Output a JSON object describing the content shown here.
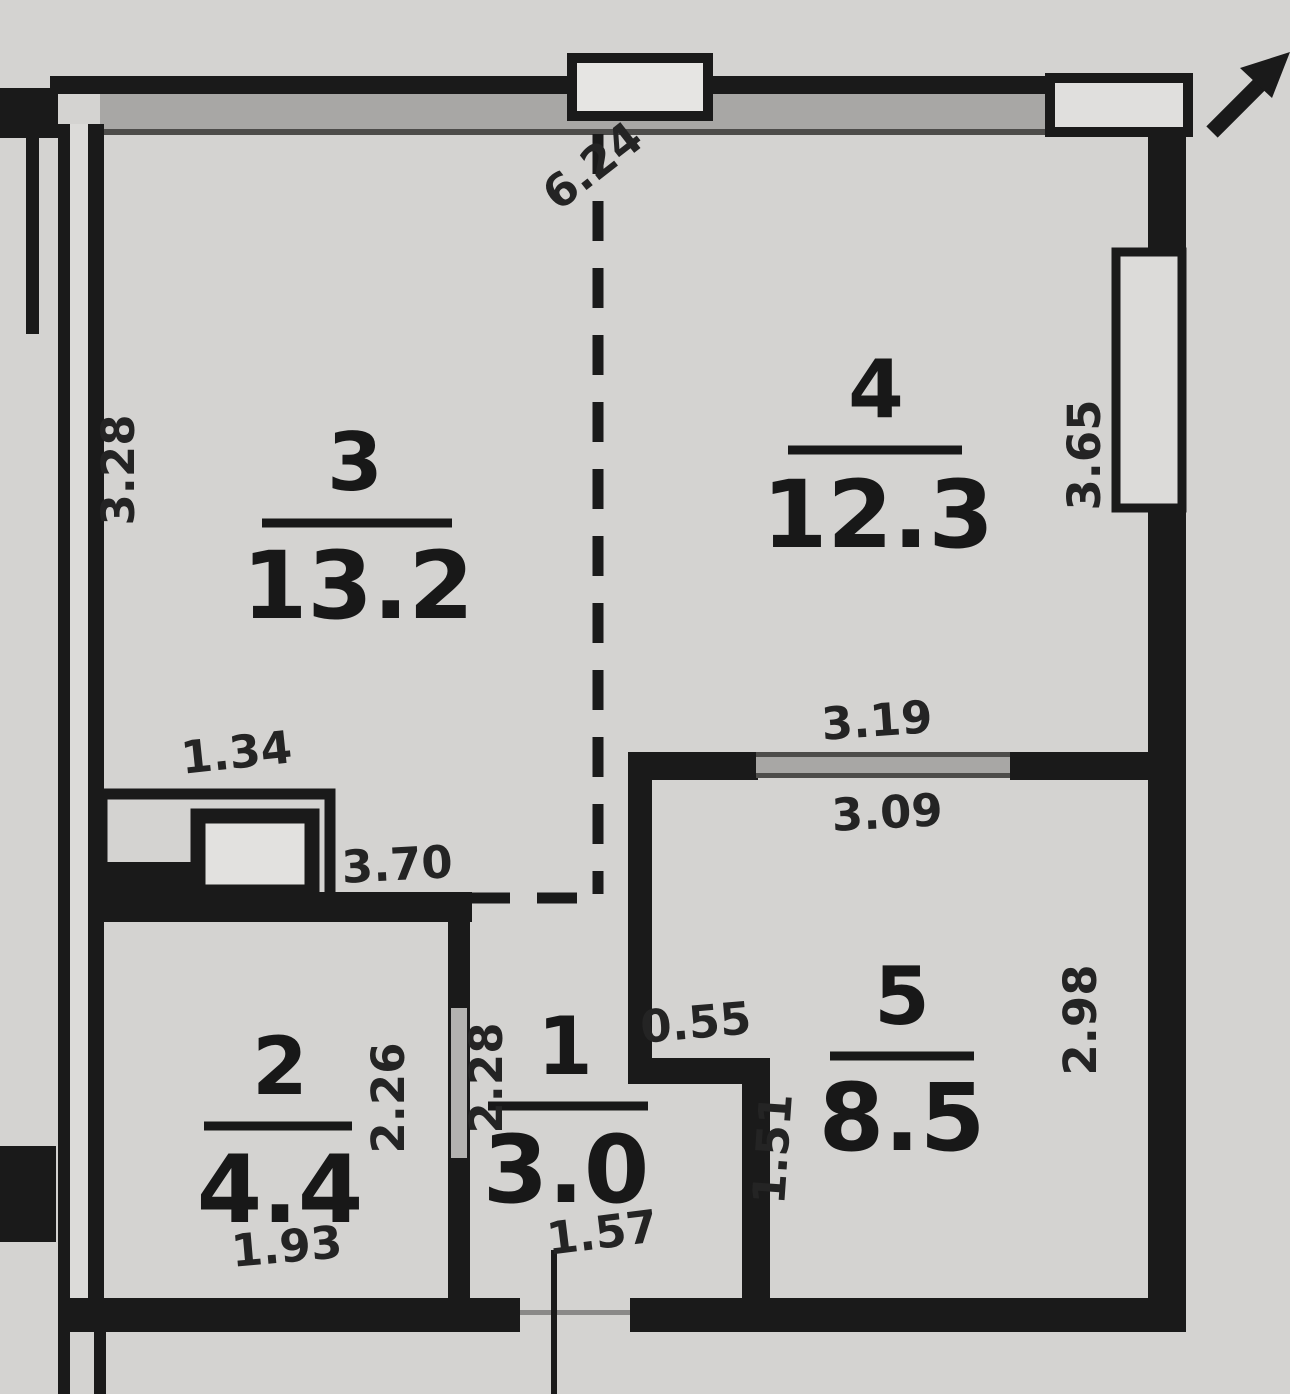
{
  "plan": {
    "title": "apartment-floor-plan",
    "rooms": [
      {
        "number": "3",
        "area": "13.2"
      },
      {
        "number": "4",
        "area": "12.3"
      },
      {
        "number": "2",
        "area": "4.4"
      },
      {
        "number": "1",
        "area": "3.0"
      },
      {
        "number": "5",
        "area": "8.5"
      }
    ],
    "dimensions": {
      "top_width": "6.24",
      "room3_left_height": "3.28",
      "room4_right_height": "3.65",
      "room4_window_outer": "3.19",
      "room4_window_inner": "3.09",
      "closet_width": "1.34",
      "room2_top_width": "3.70",
      "room2_wall_height": "2.26",
      "room1_wall_height": "2.28",
      "opening_width": "0.55",
      "room5_left_height": "1.51",
      "room5_right_height": "2.98",
      "room2_bottom_width": "1.93",
      "room1_bottom_width": "1.57"
    },
    "colors": {
      "paper": "#d4d3d1",
      "wall": "#1a1a1a",
      "window_band": "#a8a7a5",
      "text": "#181818"
    }
  }
}
